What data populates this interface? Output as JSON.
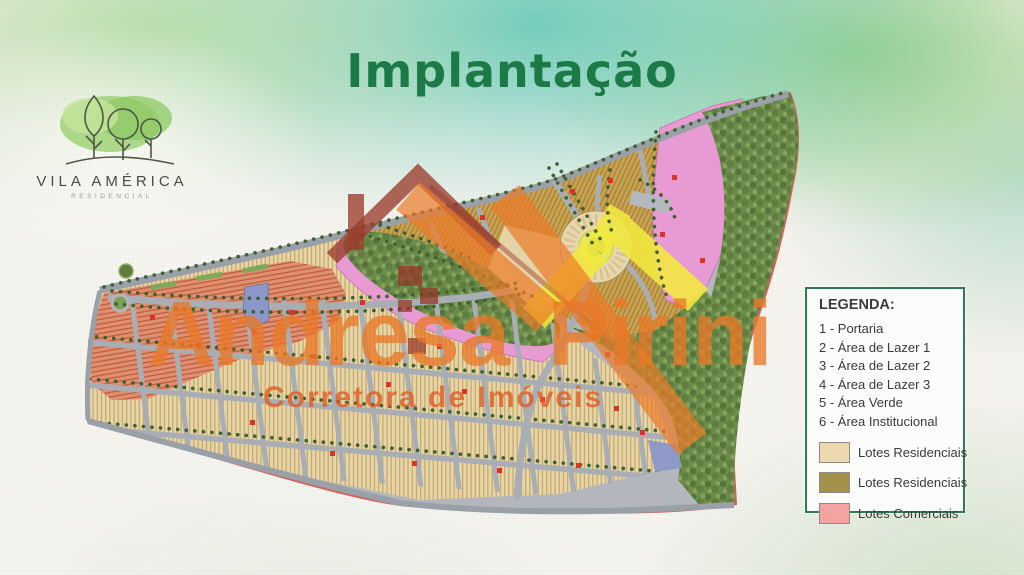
{
  "slide": {
    "title": "Implantação"
  },
  "logo": {
    "name": "VILA AMÉRICA",
    "subtitle": "RESIDENCIAL"
  },
  "legend": {
    "title": "LEGENDA:",
    "items": [
      "1 - Portaria",
      "2 - Área de Lazer 1",
      "3 - Área de Lazer 2",
      "4 - Área de Lazer 3",
      "5 - Área Verde",
      "6 - Área Institucional"
    ],
    "swatches": [
      {
        "label": "Lotes Residenciais",
        "color": "#ecd9b0"
      },
      {
        "label": "Lotes Residenciais",
        "color": "#a3914a"
      },
      {
        "label": "Lotes Comerciais",
        "color": "#f5a3a1"
      }
    ]
  },
  "watermark": {
    "name": "Andresa Pirini",
    "tagline": "Corretora de Imóveis"
  },
  "colors": {
    "title_green": "#1c7a46",
    "legend_border": "#2c7d52",
    "map_tan": "#e8d5a6",
    "map_olive": "#c9a250",
    "map_commercial": "#e09072",
    "map_forest": "#6d8c4b",
    "map_pink": "#e89bd3",
    "map_water": "#8b97c9",
    "map_yellow": "#f2e93e"
  }
}
